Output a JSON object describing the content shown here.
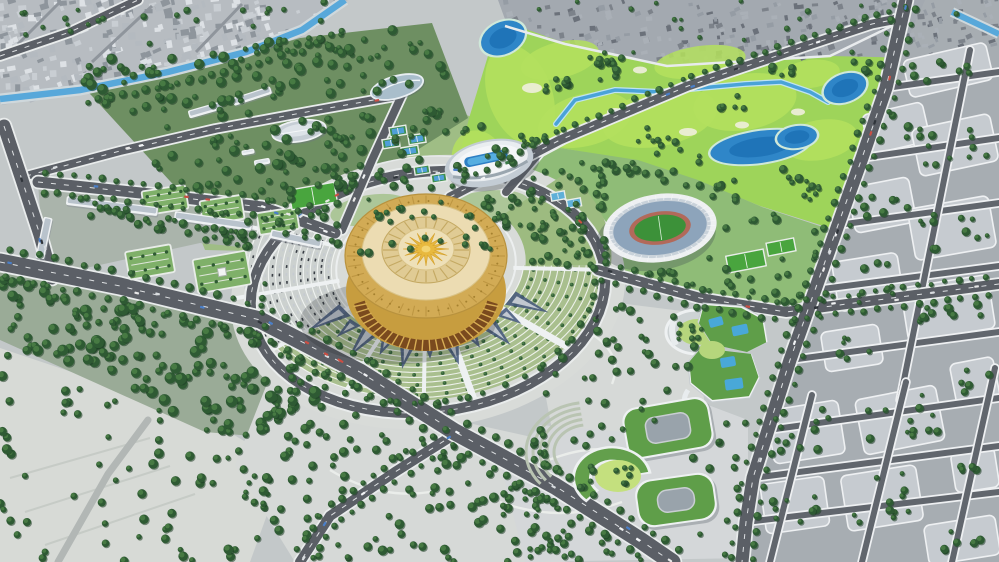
{
  "scene": {
    "type": "aerial-3d-architectural-rendering",
    "description": "Bird's-eye 3D masterplan render of a sports and culture park: a golden circular arena at the center of a radial plaza, an open-air stadium, an oval aquatic hall, a golf course with ponds, green-roof buildings, tree-lined boulevards, a canal, and surrounding city blocks.",
    "landmarks": [
      {
        "id": "golden-arena",
        "label": "Golden circular arena with sunburst roof"
      },
      {
        "id": "radial-fan-gardens",
        "label": "Concentric fan gardens and parking arcs around arena"
      },
      {
        "id": "mosaic-plaza",
        "label": "Triangular mosaic pavement around arena"
      },
      {
        "id": "ring-road",
        "label": "Elliptical ring road around central plaza"
      },
      {
        "id": "grand-boulevard",
        "label": "Main diagonal boulevard"
      },
      {
        "id": "stadium",
        "label": "Open-air stadium with running track"
      },
      {
        "id": "aquatic-center",
        "label": "Oval aquatic hall with rooftop pool"
      },
      {
        "id": "sports-dome",
        "label": "Silver oval sports hall"
      },
      {
        "id": "leaf-pavilion",
        "label": "Leaf-shaped pavilion"
      },
      {
        "id": "terraced-green-building",
        "label": "Curved building with green roofs, pools and round courtyard"
      },
      {
        "id": "green-roof-campus",
        "label": "Three green-roof courtyard buildings"
      },
      {
        "id": "golf-course",
        "label": "Golf course with stream and ponds"
      },
      {
        "id": "canal",
        "label": "Blue canal through old town"
      },
      {
        "id": "old-town",
        "label": "Dense grey existing city, top left"
      },
      {
        "id": "city-grid",
        "label": "Planned city blocks with trees, right side"
      },
      {
        "id": "sports-fields",
        "label": "Tennis courts and football pitches"
      },
      {
        "id": "tree-park",
        "label": "Dense tree park belts"
      }
    ]
  },
  "palette": {
    "base": "#c3c8c9",
    "pavement": "#d8dbd8",
    "asphalt": "#5b5f66",
    "asphaltLight": "#61666d",
    "roadEdge": "#e9ecec",
    "roadLine": "#f5f7f8",
    "cityLight": "#b7bcc1",
    "cityDark": "#a3a9b0",
    "blockFill": "#c6cbd0",
    "parkGreen": "#9fbd85",
    "sportsGreen": "#8fbc77",
    "golfGreen": "#9ed45a",
    "golfLight": "#b4e05e",
    "water": "#2f86c8",
    "waterDeep": "#1f74b8",
    "canal": "#58a8da",
    "treeDark": "#2e5a33",
    "treeLight": "#4a7d45",
    "treeShadow": "#1e3c24",
    "arenaGold": "#d2ab55",
    "arenaRoof": "#ecdcb2",
    "arenaRing": "#e0cb94",
    "arenaTrim": "#b8923e",
    "arenaDark": "#7a4a1e",
    "arenaBase": "#c79d3f",
    "sunGold": "#e8b93e",
    "stadiumWhite": "#eef0f2",
    "stadiumBowl": "#8da4bb",
    "pitch": "#3c9139",
    "track": "#b2695a",
    "roofGreen": "#5f9e49",
    "lawn": "#c4e07e",
    "glassBlue": "#49a8d8",
    "poolBlue": "#2e7fc4",
    "mosaic": "#46597c",
    "fanGarden": "#a9bf8e",
    "fanParking": "#ccd1cf",
    "white": "#eef1f2"
  }
}
